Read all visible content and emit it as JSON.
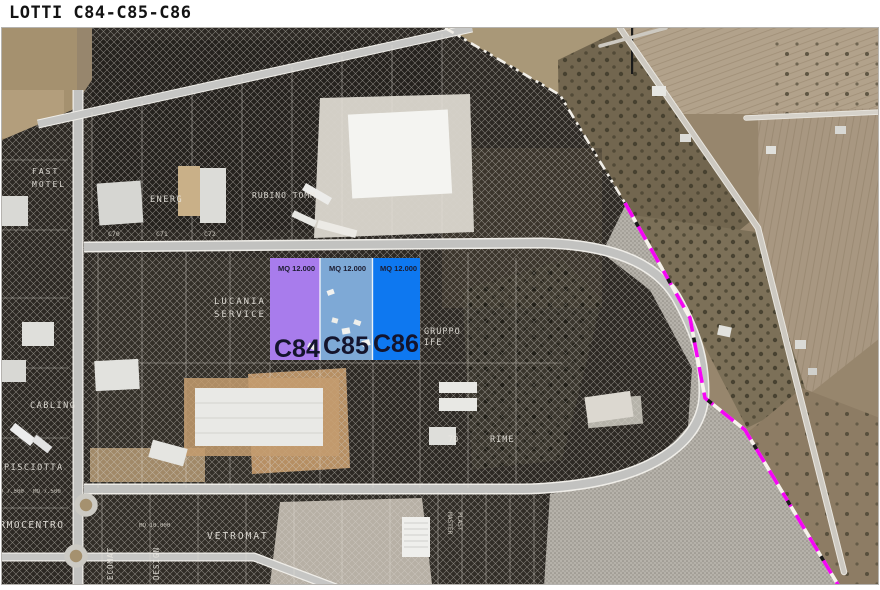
{
  "title": "LOTTI C84-C85-C86",
  "lots": {
    "c84": {
      "name": "C84",
      "area": "MQ 12.000",
      "color": "#a87cec"
    },
    "c85": {
      "name": "C85",
      "area": "MQ 12.000",
      "color": "#7ea9d6"
    },
    "c86": {
      "name": "C86",
      "area": "MQ 12.000",
      "color": "#0e78f0"
    }
  },
  "boundary": {
    "color": "#f505f5",
    "style": "dashed"
  },
  "labels": {
    "fast": "FAST",
    "motel": "MOTEL",
    "energ": "ENERG",
    "rubino": "RUBINO TOMM",
    "lucania": "LUCANIA",
    "service": "SERVICE",
    "gruppo": "GRUPPO",
    "ife": "IFE",
    "cabling": "CABLING",
    "pisciotta": "PISCIOTTA",
    "termocentro": "TERMOCENTRO",
    "vetromat": "VETROMAT",
    "rime": "RIME",
    "seventy": "70",
    "design": "DESIGN",
    "ecomat": "ECOMAT",
    "master": "MASTER",
    "plast": "PLAST",
    "mq7500": "MQ 7.500",
    "mq10000": "MQ 10.000",
    "c70": "C70",
    "c71": "C71",
    "c72": "C72"
  }
}
